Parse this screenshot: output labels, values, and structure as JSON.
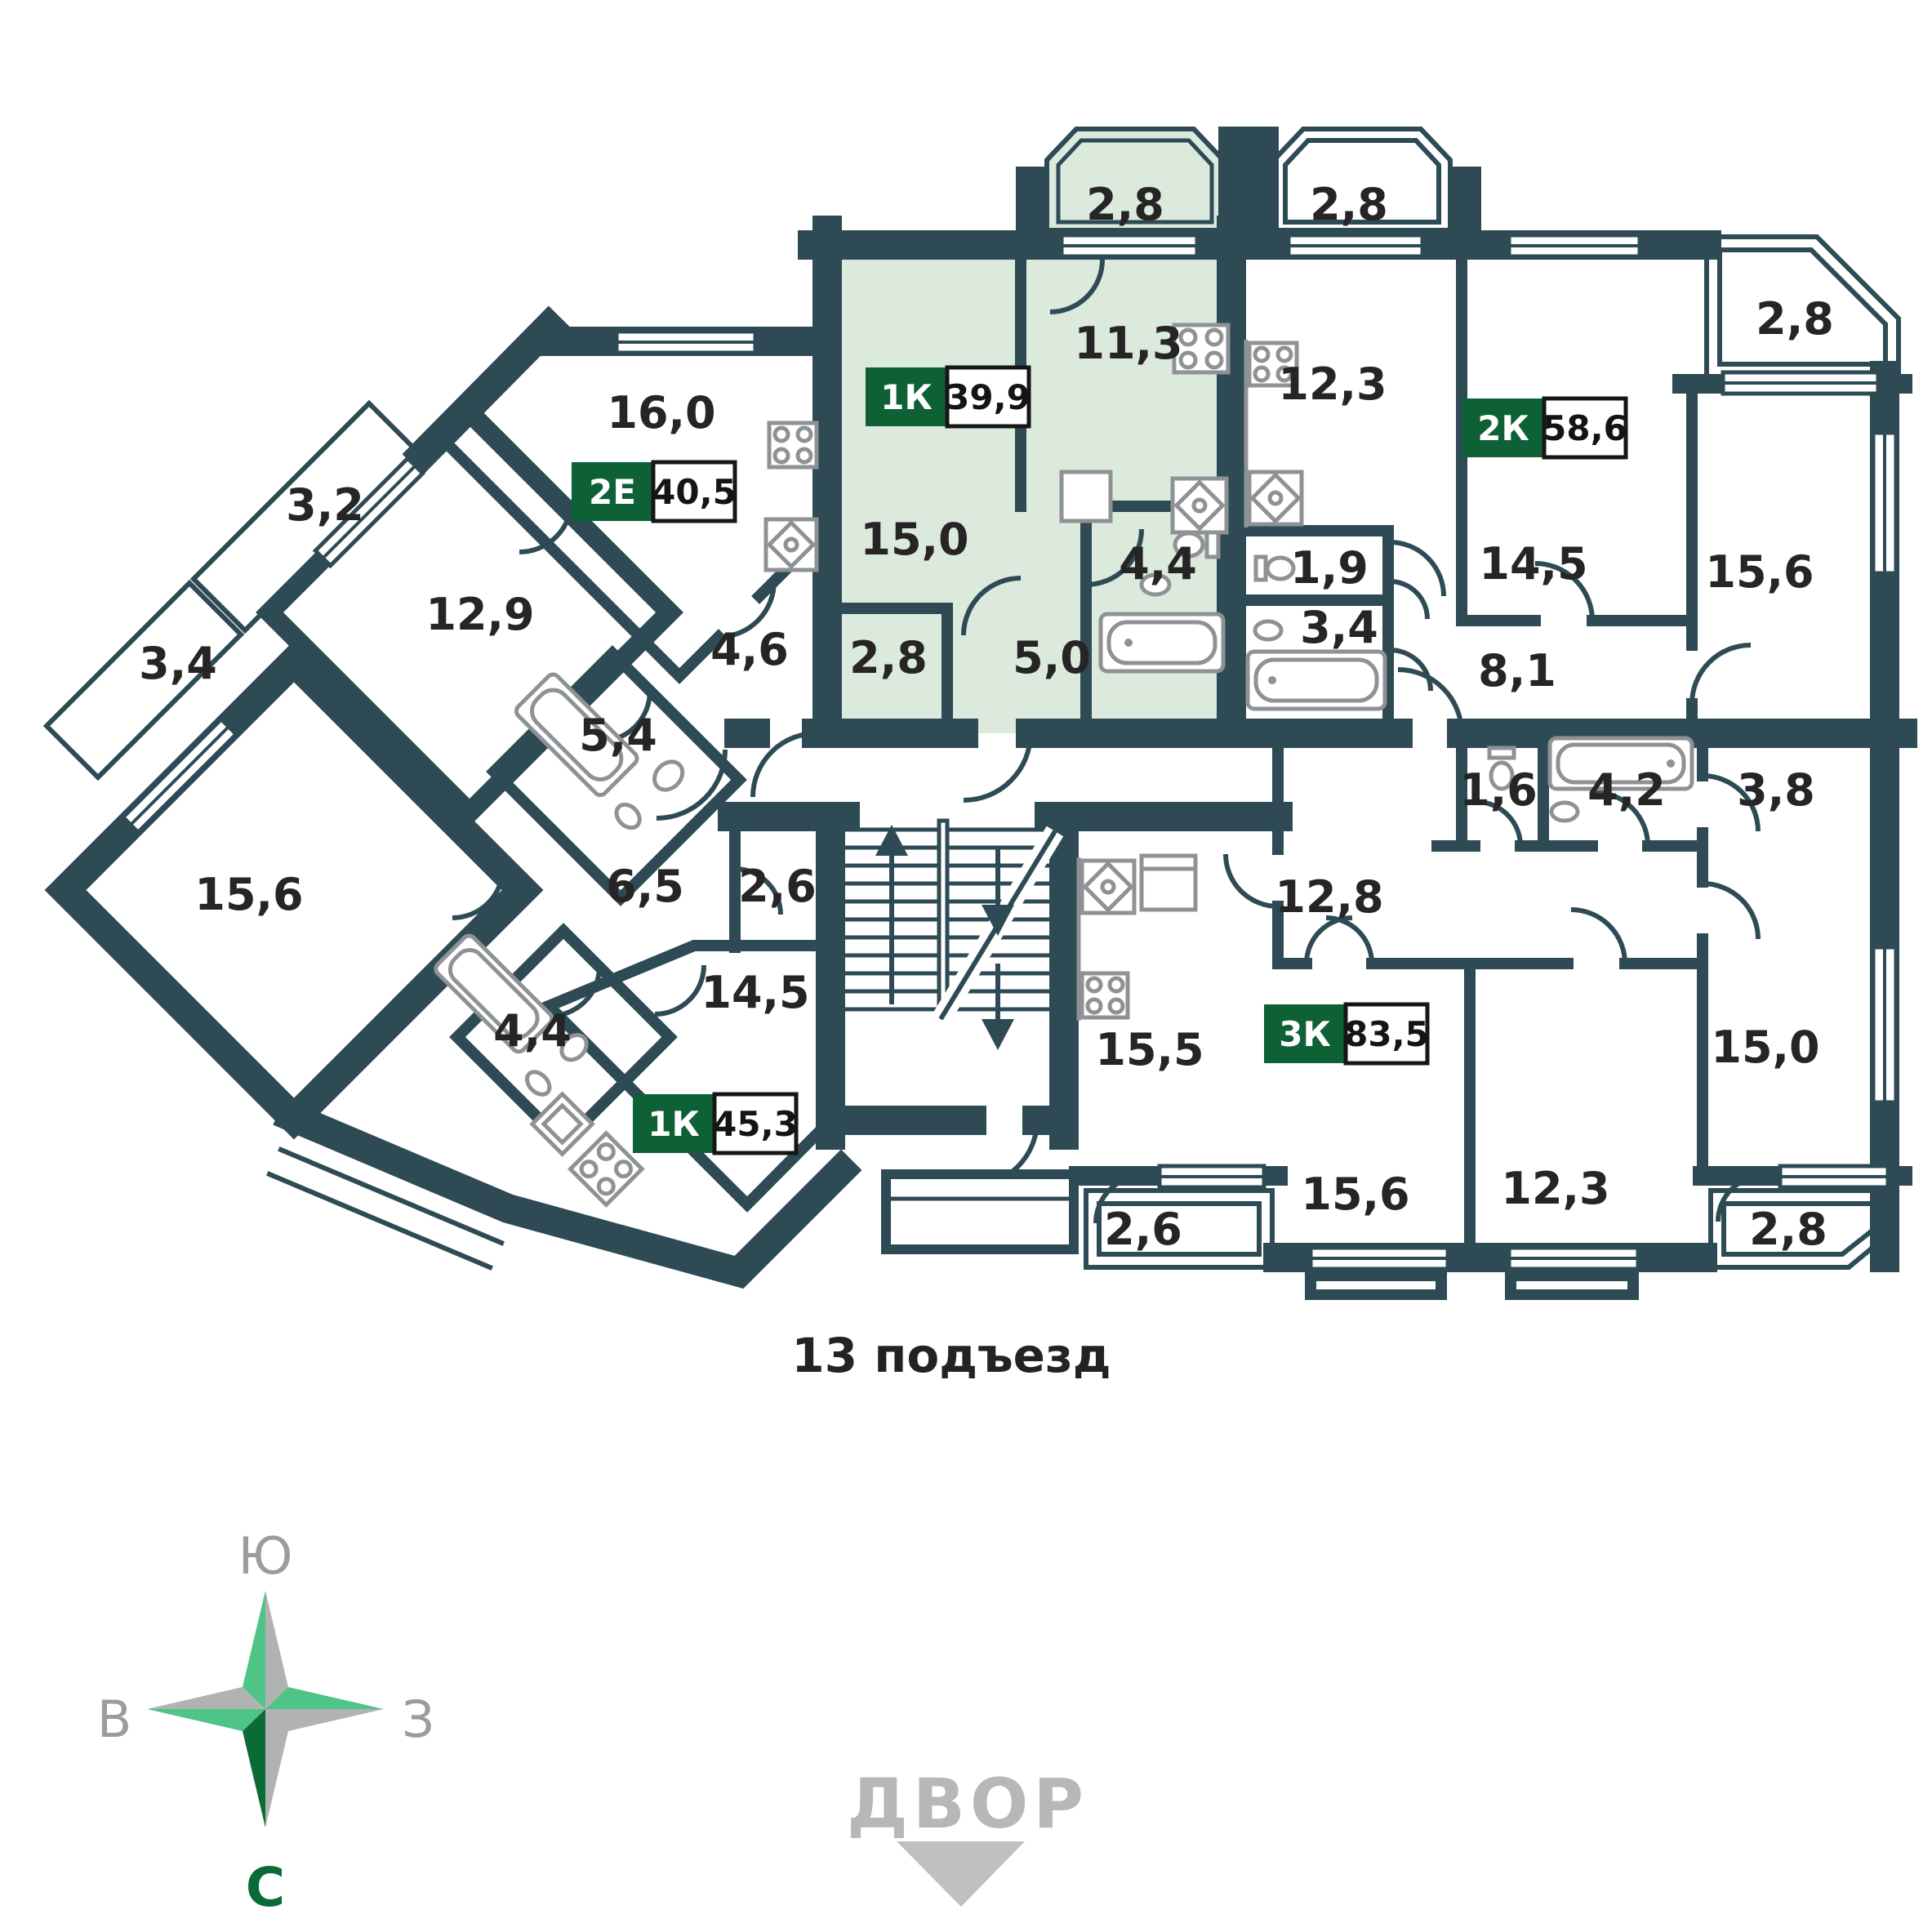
{
  "colors": {
    "wall": "#2e4b55",
    "highlight_fill": "#dceadd",
    "badge_green": "#0d6135",
    "label_text": "#262424",
    "fixture_gray": "#8f9294",
    "compass_light_green": "#4fc487",
    "compass_dark_green": "#0a6b37",
    "compass_gray": "#b0b3b2",
    "courtyard_gray": "#b5b8b7"
  },
  "plan": {
    "entrance_label": "13 подъезд",
    "courtyard_label": "ДВОР",
    "compass": {
      "south": "Ю",
      "east": "В",
      "west": "З",
      "north": "С"
    },
    "apartments": [
      {
        "type": "2Е",
        "area": "40,5",
        "highlighted": false
      },
      {
        "type": "1К",
        "area": "39,9",
        "highlighted": true
      },
      {
        "type": "2К",
        "area": "58,6",
        "highlighted": false
      },
      {
        "type": "1К",
        "area": "45,3",
        "highlighted": false
      },
      {
        "type": "3К",
        "area": "83,5",
        "highlighted": false
      }
    ],
    "rooms": [
      {
        "label": "2,8"
      },
      {
        "label": "2,8"
      },
      {
        "label": "2,8"
      },
      {
        "label": "16,0"
      },
      {
        "label": "11,3"
      },
      {
        "label": "15,0"
      },
      {
        "label": "2,8"
      },
      {
        "label": "5,0"
      },
      {
        "label": "4,4"
      },
      {
        "label": "4,6"
      },
      {
        "label": "12,3"
      },
      {
        "label": "1,9"
      },
      {
        "label": "3,4"
      },
      {
        "label": "14,5"
      },
      {
        "label": "15,6"
      },
      {
        "label": "8,1"
      },
      {
        "label": "3,2"
      },
      {
        "label": "12,9"
      },
      {
        "label": "3,4"
      },
      {
        "label": "15,6"
      },
      {
        "label": "5,4"
      },
      {
        "label": "6,5"
      },
      {
        "label": "2,6"
      },
      {
        "label": "14,5"
      },
      {
        "label": "4,4"
      },
      {
        "label": "15,5"
      },
      {
        "label": "12,8"
      },
      {
        "label": "1,6"
      },
      {
        "label": "4,2"
      },
      {
        "label": "3,8"
      },
      {
        "label": "15,6"
      },
      {
        "label": "12,3"
      },
      {
        "label": "15,0"
      },
      {
        "label": "2,6"
      },
      {
        "label": "2,8"
      }
    ]
  }
}
